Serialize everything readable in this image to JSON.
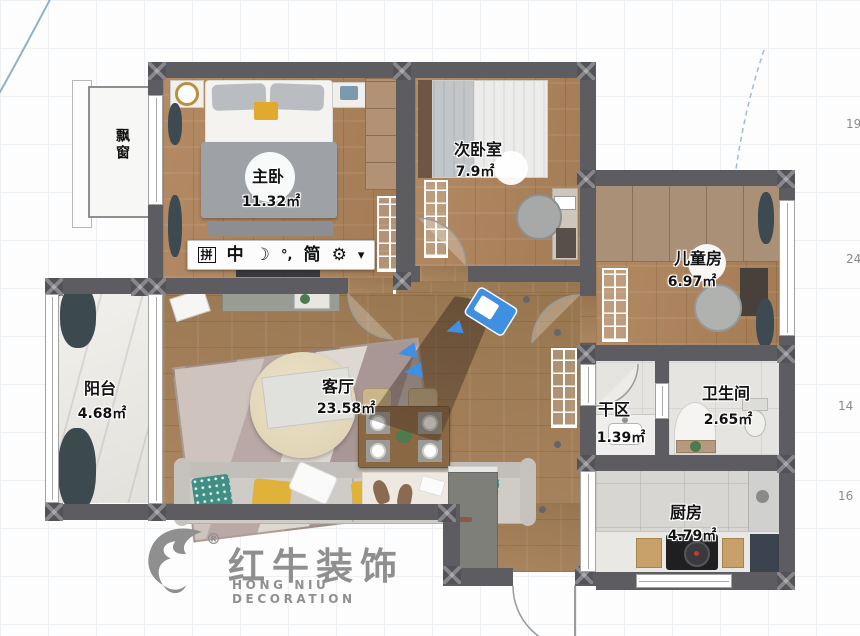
{
  "plan": {
    "rooms": [
      {
        "name": "主卧",
        "area": "11.32㎡"
      },
      {
        "name": "次卧室",
        "area": "7.9㎡"
      },
      {
        "name": "儿童房",
        "area": "6.97㎡"
      },
      {
        "name": "阳台",
        "area": "4.68㎡"
      },
      {
        "name": "客厅",
        "area": "23.58㎡"
      },
      {
        "name": "干区",
        "area": "1.39㎡"
      },
      {
        "name": "卫生间",
        "area": "2.65㎡"
      },
      {
        "name": "厨房",
        "area": "4.79㎡"
      }
    ],
    "bay_window": {
      "label": "飘窗"
    }
  },
  "ime_toolbar": {
    "pinyin_label": "拼",
    "mode_label": "中",
    "moon_icon": "☽",
    "punctuation_label": "°,",
    "simplified_label": "简",
    "gear_icon": "⚙",
    "more_icon": "▾"
  },
  "dimensions": {
    "right_labels": [
      "19",
      "24",
      "14",
      "16"
    ]
  },
  "logo": {
    "cn_name": "红牛装饰",
    "en_name": "HONG NIU DECORATION",
    "registered_mark": "®"
  },
  "colors": {
    "wall": "#5d5c61",
    "wood_floor": "#ad8560",
    "marble_floor": "#edebe7",
    "tile_floor": "#d7d6d3",
    "camera_blue": "#3f8fe3",
    "logo_gray": "#8f8f8f"
  }
}
